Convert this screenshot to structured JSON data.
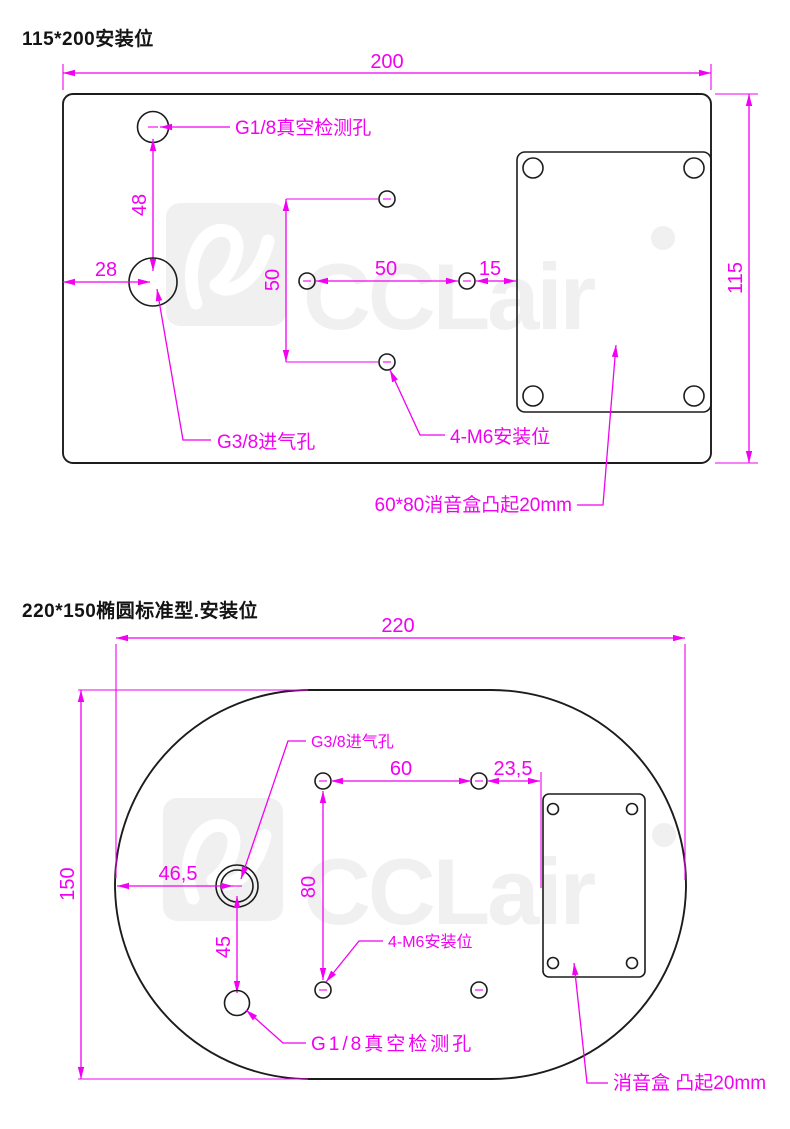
{
  "colors": {
    "dimension": "#f200f2",
    "drawing": "#1c1c1c",
    "watermark": "#f0f0f0"
  },
  "watermark": {
    "text": "CCLair"
  },
  "top_drawing": {
    "title": "115*200安装位",
    "dims": {
      "width": "200",
      "height": "115",
      "vacuum_to_intake": "48",
      "edge_to_intake": "28",
      "pattern_vertical": "50",
      "pattern_horizontal": "50",
      "pattern_to_box": "15"
    },
    "labels": {
      "vacuum_port": "G1/8真空检测孔",
      "intake_port": "G3/8进气孔",
      "mounting_holes": "4-M6安装位",
      "muffler_box": "60*80消音盒凸起20mm"
    }
  },
  "bottom_drawing": {
    "title": "220*150椭圆标准型.安装位",
    "dims": {
      "width": "220",
      "height": "150",
      "edge_to_intake": "46,5",
      "intake_to_vacuum": "45",
      "pattern_horizontal": "60",
      "pattern_vertical": "80",
      "pattern_to_box": "23,5"
    },
    "labels": {
      "intake_port": "G3/8进气孔",
      "vacuum_port": "G1/8真空检测孔",
      "mounting_holes": "4-M6安装位",
      "muffler_box": "消音盒 凸起20mm"
    }
  }
}
